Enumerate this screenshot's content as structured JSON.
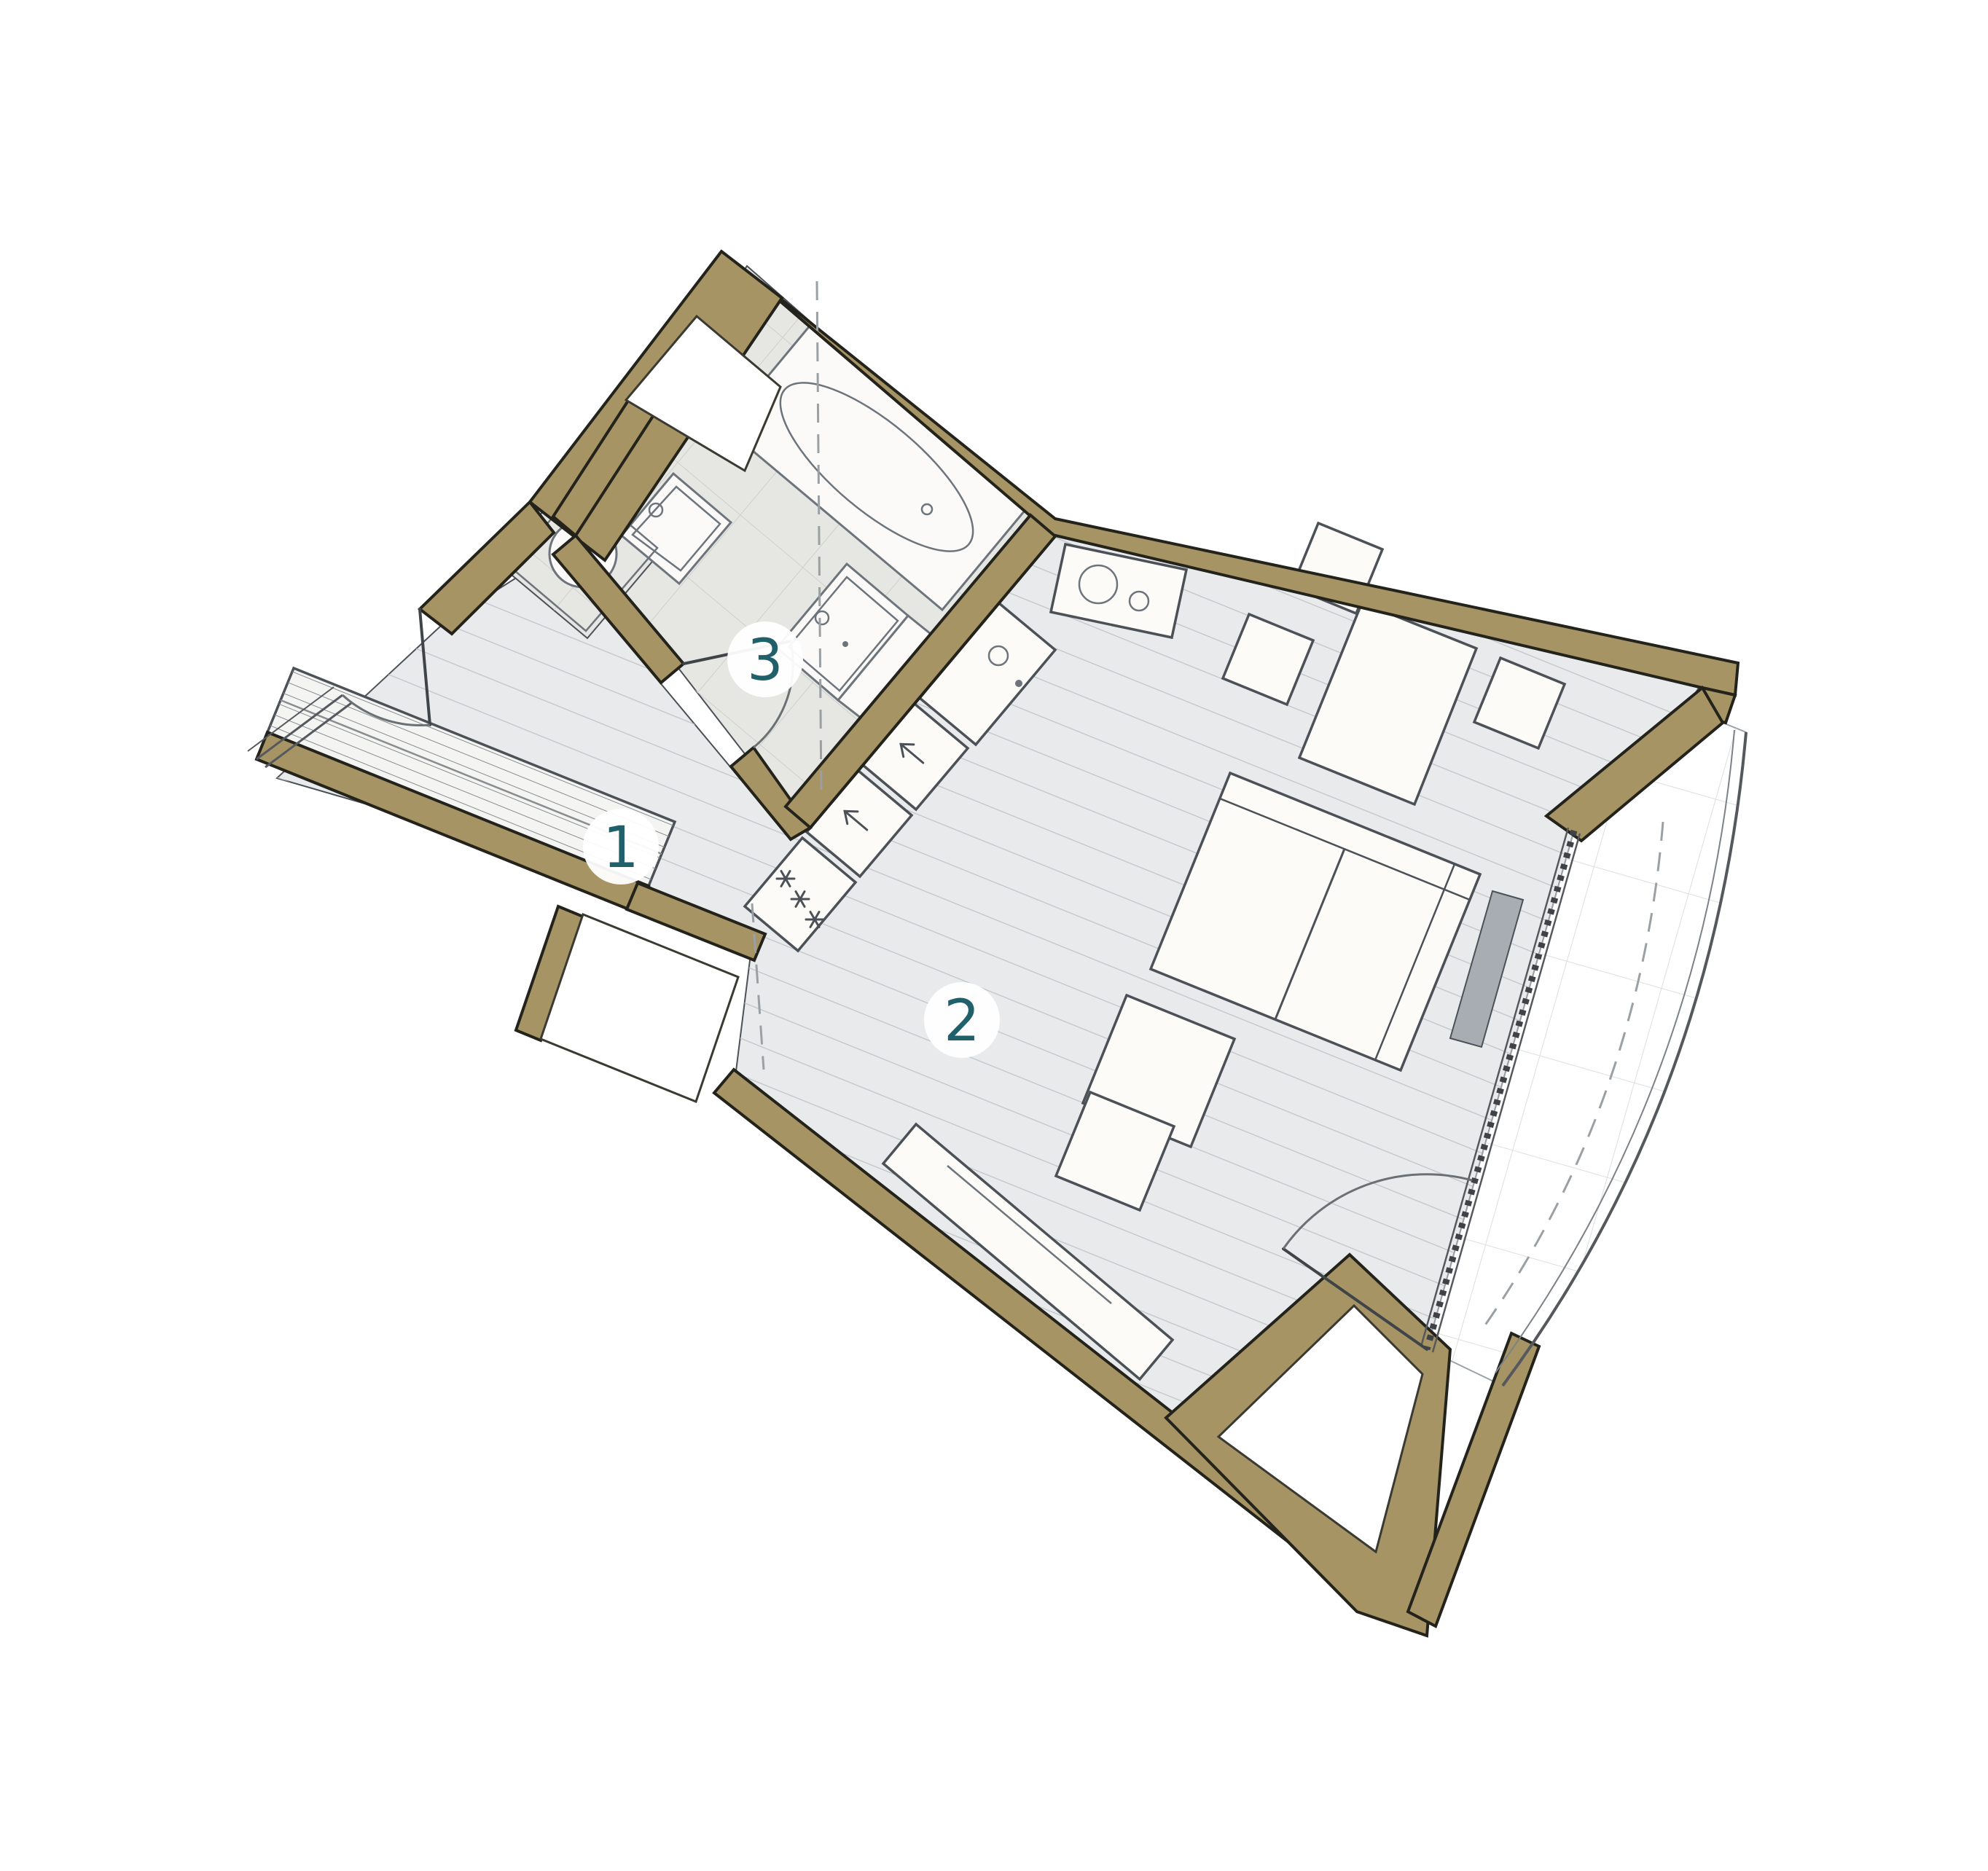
{
  "page": {
    "background": "#ffffff",
    "content_type": "apartment floor plan, rotated top view"
  },
  "plan": {
    "room_labels": [
      {
        "number": "1",
        "meaning": "hall-entry"
      },
      {
        "number": "2",
        "meaning": "living-kitchen"
      },
      {
        "number": "3",
        "meaning": "bathroom"
      }
    ],
    "colors": {
      "wall_fill": "#a79465",
      "wall_outline": "#23231c",
      "floor_fill": "#e9eaeb",
      "floor_hatch": "#c0c3c7",
      "bath_floor_fill": "#e6e6e3",
      "tile_line": "#cfd0cc",
      "balcony_grid": "#dcdee0",
      "furniture_fill": "#fcfbf8",
      "furniture_stroke": "#4b5157",
      "fixture_stroke": "#6d747b",
      "label_color": "#20606a",
      "badge_fill": "#ffffff",
      "dash_color": "#9aa0a4",
      "glazing_color": "#3f4347",
      "radiator_fill": "#a7adb2"
    },
    "fixtures": [
      "bathtub",
      "washbasin",
      "toilet",
      "washing-machine",
      "shaft",
      "kitchen-sink",
      "cooktop",
      "oven",
      "dishwasher",
      "freezer",
      "dining-table",
      "dining-chair",
      "sofa",
      "coffee-tables",
      "tv-sideboard",
      "wardrobe",
      "radiator",
      "entry-door",
      "bathroom-door",
      "balcony-door",
      "window",
      "balcony",
      "roof-slope-line"
    ]
  }
}
